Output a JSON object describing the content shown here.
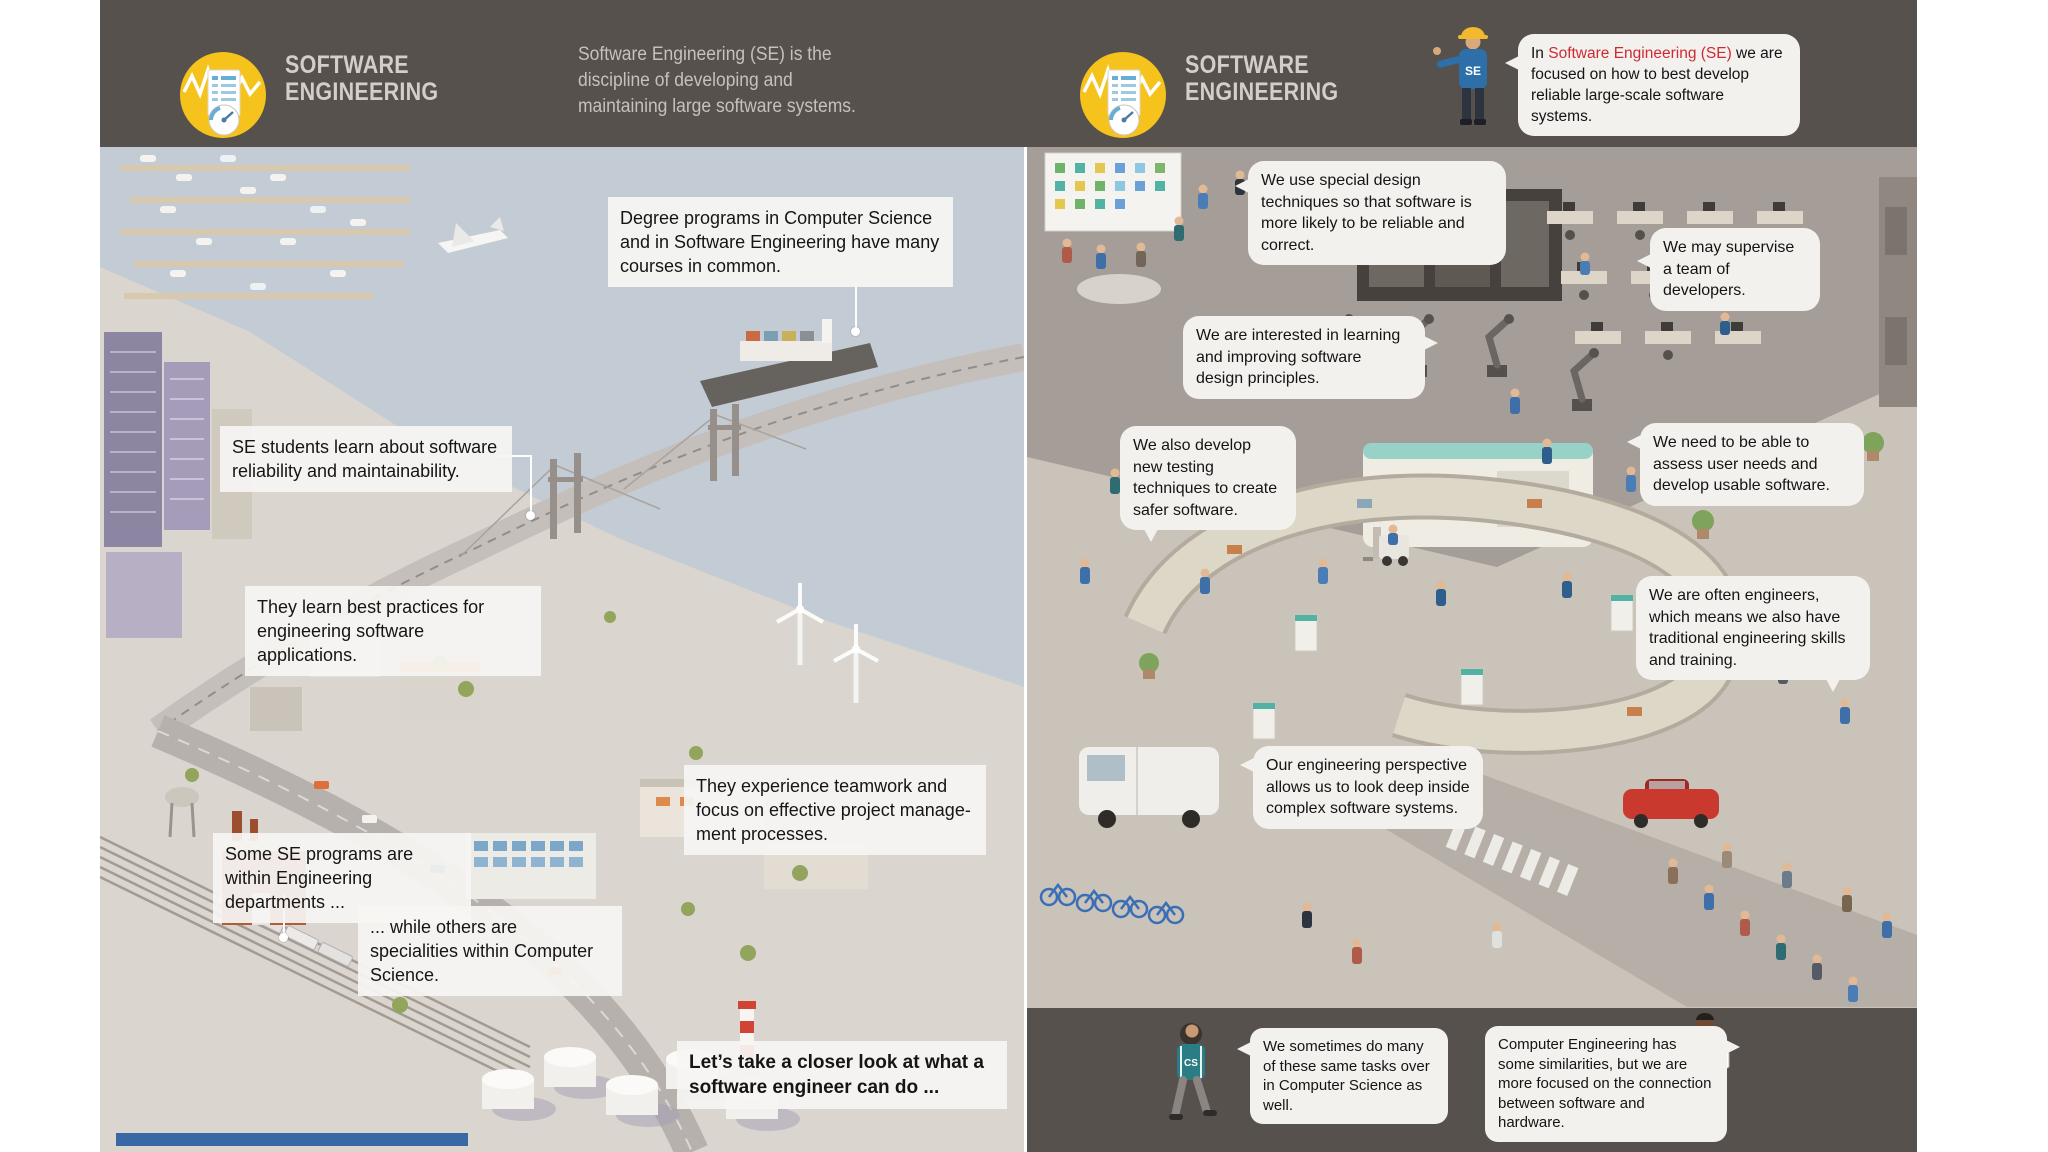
{
  "colors": {
    "header_bg": "#57514d",
    "accent_red": "#cf2a33",
    "logo_yellow": "#f6c31c",
    "callout_bg": "#f3f2ef",
    "bubble_bg": "#f2f1ee",
    "text_dark": "#151515",
    "header_text": "#d3cec9"
  },
  "header": {
    "logo_title_line1": "SOFTWARE",
    "logo_title_line2": "ENGINEERING",
    "description": "Software Engineering (SE) is the discipline of developing and maintaining large software systems.",
    "intro_bubble": {
      "pre": "In ",
      "highlight": "Software Engineering (SE)",
      "post": " we are focused on how to best develop reliable large-scale software systems."
    },
    "se_badge": "SE"
  },
  "left_panel": {
    "callouts": [
      {
        "id": "degree-programs",
        "text": "Degree programs in Computer Science and in Software Engineering have many courses in common."
      },
      {
        "id": "se-students",
        "text": "SE students learn about software reliability and maintainability."
      },
      {
        "id": "best-practices",
        "text": "They learn best practices for engineering software applications."
      },
      {
        "id": "teamwork",
        "text": "They experience teamwork and focus on effective project manage-ment processes."
      },
      {
        "id": "se-programs",
        "text": "Some SE programs are within Engineering departments ..."
      },
      {
        "id": "specialities",
        "text": "... while others are specialities within Computer Science."
      },
      {
        "id": "closer-look",
        "text": "Let’s take a closer look at what a software engineer can do ..."
      }
    ]
  },
  "right_panel": {
    "bubbles": [
      {
        "id": "design-techniques",
        "text": "We use special design techniques so that software is more likely to be reliable and correct."
      },
      {
        "id": "supervise",
        "text": "We may supervise a team of developers."
      },
      {
        "id": "learning",
        "text": "We are interested in learning and improving software design principles."
      },
      {
        "id": "testing",
        "text": "We also develop new testing techniques to create safer software."
      },
      {
        "id": "assess",
        "text": "We need to be able to assess user needs and develop usable software."
      },
      {
        "id": "often-engineers",
        "text": "We are often engineers, which means we also have traditional engineering skills and training."
      },
      {
        "id": "perspective",
        "text": "Our engineering perspective allows us to look deep inside complex software systems."
      }
    ],
    "footer_bubbles": [
      {
        "id": "same-tasks",
        "text": "We sometimes do many of these same tasks over in Computer Science as well."
      },
      {
        "id": "computer-engineering",
        "text": "Computer Engineering has some similarities, but we are more focused on the connection between software and hardware."
      }
    ],
    "cs_badge": "CS"
  }
}
